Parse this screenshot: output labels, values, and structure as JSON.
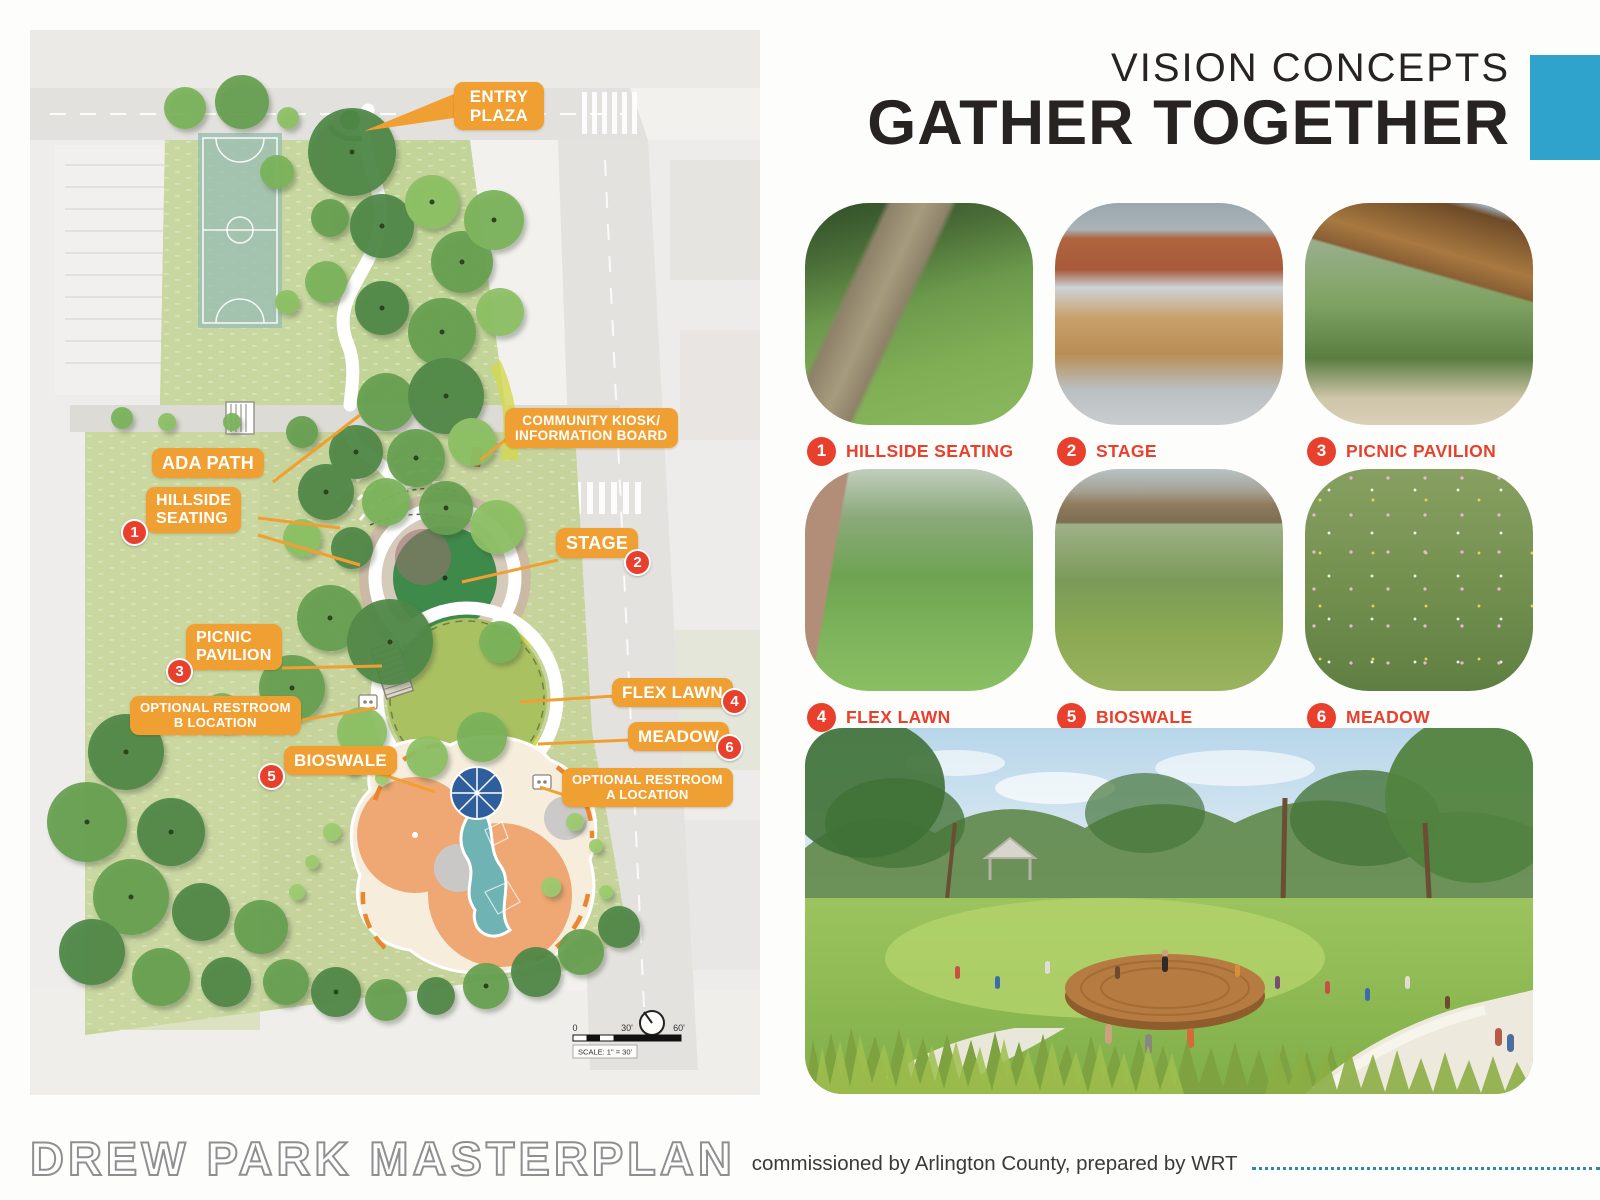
{
  "header": {
    "eyebrow": "VISION CONCEPTS",
    "title": "GATHER TOGETHER"
  },
  "features": [
    {
      "num": "1",
      "label": "HILLSIDE SEATING"
    },
    {
      "num": "2",
      "label": "STAGE"
    },
    {
      "num": "3",
      "label": "PICNIC PAVILION"
    },
    {
      "num": "4",
      "label": "FLEX LAWN"
    },
    {
      "num": "5",
      "label": "BIOSWALE"
    },
    {
      "num": "6",
      "label": "MEADOW"
    }
  ],
  "map": {
    "callouts": [
      {
        "id": "entry-plaza",
        "label": "ENTRY\nPLAZA"
      },
      {
        "id": "community-kiosk",
        "label": "COMMUNITY KIOSK/\nINFORMATION BOARD"
      },
      {
        "id": "ada-path",
        "label": "ADA PATH"
      },
      {
        "id": "hillside-seating",
        "label": "HILLSIDE\nSEATING",
        "num": "1"
      },
      {
        "id": "stage",
        "label": "STAGE",
        "num": "2"
      },
      {
        "id": "picnic-pavilion",
        "label": "PICNIC\nPAVILION",
        "num": "3"
      },
      {
        "id": "restroom-b",
        "label": "OPTIONAL RESTROOM\nB LOCATION"
      },
      {
        "id": "flex-lawn",
        "label": "FLEX LAWN",
        "num": "4"
      },
      {
        "id": "meadow",
        "label": "MEADOW",
        "num": "6"
      },
      {
        "id": "bioswale",
        "label": "BIOSWALE",
        "num": "5"
      },
      {
        "id": "restroom-a",
        "label": "OPTIONAL RESTROOM\nA LOCATION"
      }
    ],
    "scale_bar": {
      "start": "0",
      "mid": "30'",
      "end": "60'",
      "note": "SCALE: 1\" = 30'"
    }
  },
  "footer": {
    "title": "DREW PARK MASTERPLAN",
    "credit": "commissioned by Arlington County, prepared by WRT"
  },
  "colors": {
    "accent_blue": "#2fa3cc",
    "callout_orange": "#f0a032",
    "badge_red": "#e8402c"
  }
}
